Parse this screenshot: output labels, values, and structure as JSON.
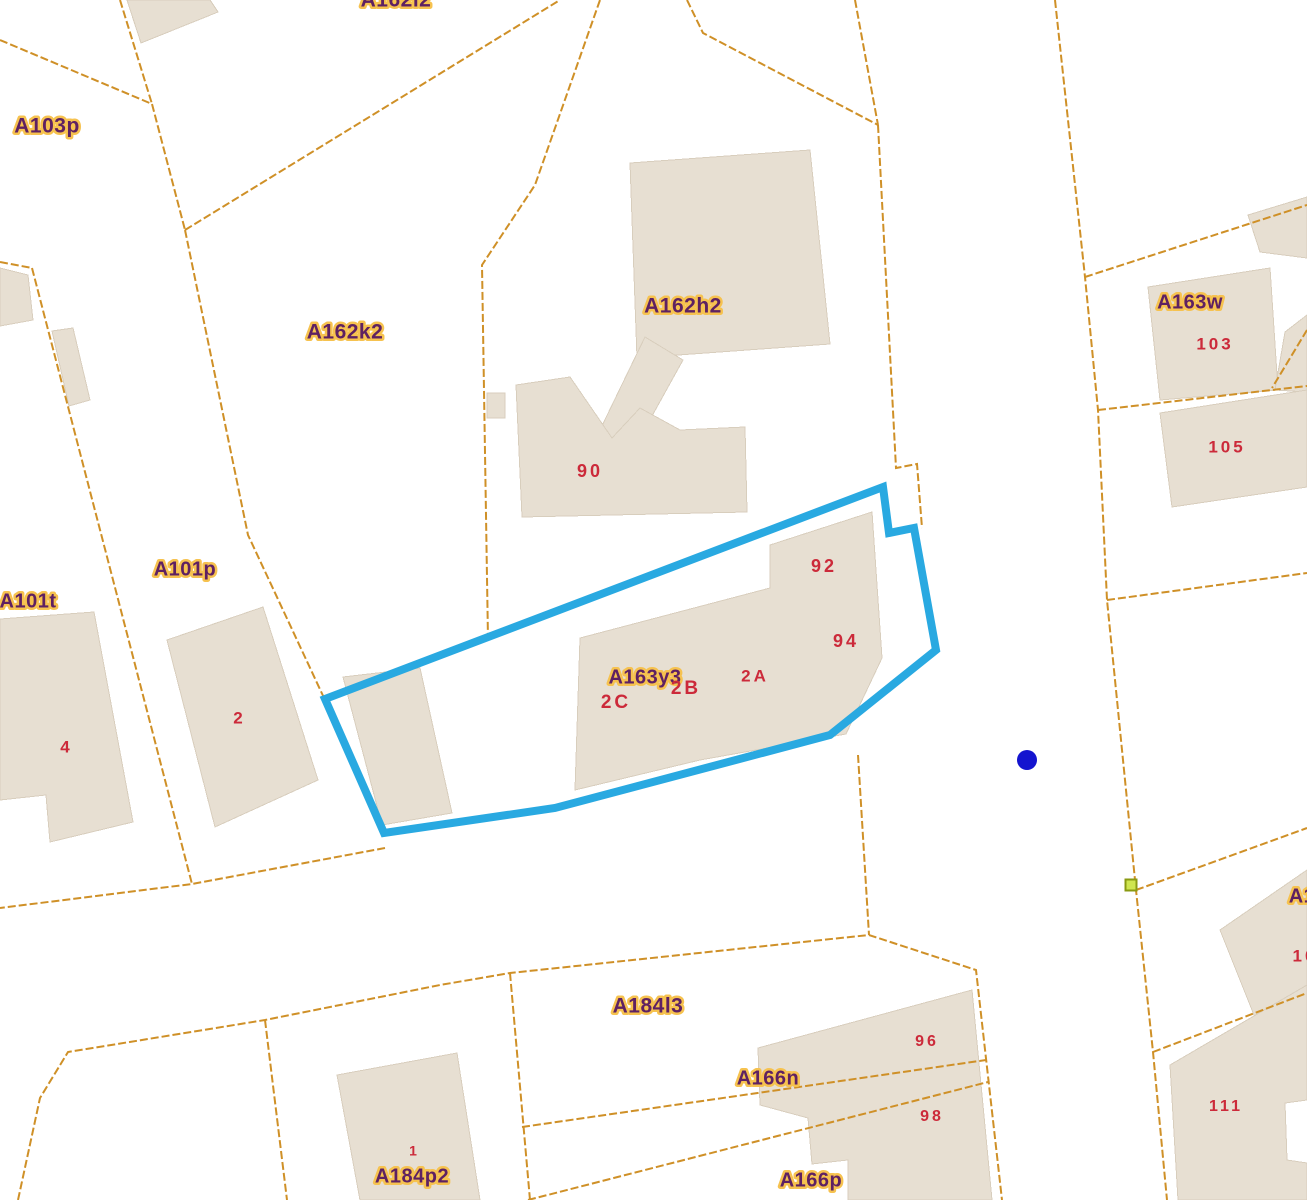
{
  "map": {
    "width": 1307,
    "height": 1200,
    "background": "#ffffff",
    "colors": {
      "parcel_line": "#cf9027",
      "building_fill": "#e7dfd2",
      "building_stroke": "#d8cebd",
      "parcel_label_fill": "#5e2162",
      "parcel_label_halo": "#f6c24f",
      "building_number_fill": "#cc2a3a",
      "highlight_stroke": "#29a9e1",
      "marker_dot_fill": "#1414cf",
      "vertex_square_fill": "#cfe550",
      "vertex_square_stroke": "#8a9a12"
    },
    "highlight_parcel": {
      "name": "selected-parcel-A163y3",
      "points": "325,699 883,487 889,533 914,528 936,650 830,735 555,808 384,833",
      "stroke_width": 8
    },
    "buildings": [
      {
        "name": "building-topleft-corner",
        "points": "127,0 210,0 218,12 141,43"
      },
      {
        "name": "building-leftedge-small",
        "points": "0,268 28,275 33,320 0,326"
      },
      {
        "name": "building-leftedge-thin",
        "points": "52,331 73,328 90,400 69,406"
      },
      {
        "name": "building-A162h2-block",
        "points": "630,163 810,150 830,344 637,358"
      },
      {
        "name": "building-A162h2-arm",
        "points": "645,337 683,360 632,452 600,430"
      },
      {
        "name": "building-90",
        "points": "516,385 570,377 612,438 640,408 680,430 745,427 747,512 522,517"
      },
      {
        "name": "building-tiny-square",
        "points": "487,393 505,393 505,418 487,418"
      },
      {
        "name": "building-4",
        "points": "0,619 94,612 133,822 50,842 46,795 0,800"
      },
      {
        "name": "building-2",
        "points": "167,640 263,607 318,780 215,827"
      },
      {
        "name": "building-outbuilding-in-parcel",
        "points": "343,677 420,668 452,813 382,825"
      },
      {
        "name": "building-92-94-2A",
        "points": "580,638 770,588 770,545 872,512 882,658 846,734 700,760 575,790"
      },
      {
        "name": "building-topright-corner",
        "points": "1248,215 1307,197 1307,258 1260,252"
      },
      {
        "name": "building-103",
        "points": "1148,287 1270,268 1278,390 1160,400"
      },
      {
        "name": "building-right-sliver",
        "points": "1285,332 1307,315 1307,392 1275,390"
      },
      {
        "name": "building-105",
        "points": "1160,413 1307,390 1307,487 1172,507"
      },
      {
        "name": "building-right-mid",
        "points": "1220,930 1307,870 1307,1010 1262,1035"
      },
      {
        "name": "building-111",
        "points": "1170,1065 1307,985 1307,1100 1285,1103 1287,1160 1307,1163 1307,1200 1178,1200"
      },
      {
        "name": "building-96-98",
        "points": "758,1048 972,990 992,1200 848,1200 848,1160 812,1164 808,1118 760,1105"
      },
      {
        "name": "building-1",
        "points": "337,1075 457,1053 480,1200 360,1200"
      }
    ],
    "parcel_lines": [
      {
        "name": "boundary",
        "points": "0,40 152,104"
      },
      {
        "name": "boundary",
        "points": "120,0 152,104"
      },
      {
        "name": "boundary",
        "points": "152,104 185,230"
      },
      {
        "name": "boundary",
        "points": "185,230 560,0"
      },
      {
        "name": "boundary",
        "points": "185,230 248,535 325,700"
      },
      {
        "name": "boundary",
        "points": "600,0 535,185 482,265 488,640"
      },
      {
        "name": "boundary",
        "points": "687,0 703,33 878,125"
      },
      {
        "name": "boundary",
        "points": "855,0 878,125"
      },
      {
        "name": "boundary",
        "points": "878,125 896,468 917,464 922,528"
      },
      {
        "name": "boundary",
        "points": "858,755 869,935"
      },
      {
        "name": "boundary",
        "points": "0,262 32,268"
      },
      {
        "name": "boundary",
        "points": "32,268 192,884"
      },
      {
        "name": "boundary",
        "points": "385,848 192,884 0,908"
      },
      {
        "name": "boundary",
        "points": "18,1200 40,1098 68,1052 265,1020 440,985 510,973 869,935 976,970 1002,1200"
      },
      {
        "name": "boundary",
        "points": "265,1020 287,1200"
      },
      {
        "name": "boundary",
        "points": "510,973 530,1200"
      },
      {
        "name": "boundary",
        "points": "522,1127 986,1060"
      },
      {
        "name": "boundary",
        "points": "528,1200 988,1082"
      },
      {
        "name": "road-boundary",
        "points": "1055,0 1085,277 1098,410 1107,600 1136,890 1153,1052 1167,1200"
      },
      {
        "name": "boundary",
        "points": "1085,277 1307,205"
      },
      {
        "name": "boundary",
        "points": "1098,410 1307,386"
      },
      {
        "name": "boundary",
        "points": "1307,330 1272,388"
      },
      {
        "name": "boundary",
        "points": "1107,600 1307,573"
      },
      {
        "name": "boundary",
        "points": "1136,890 1307,828"
      },
      {
        "name": "boundary",
        "points": "1153,1052 1307,993"
      }
    ],
    "labels": [
      {
        "text": "A103p",
        "kind": "parcel",
        "x": 47,
        "y": 127,
        "size": 21
      },
      {
        "text": "A162l2",
        "kind": "parcel",
        "x": 396,
        "y": 1,
        "size": 21
      },
      {
        "text": "A162k2",
        "kind": "parcel",
        "x": 345,
        "y": 333,
        "size": 21
      },
      {
        "text": "A162h2",
        "kind": "parcel",
        "x": 683,
        "y": 307,
        "size": 21
      },
      {
        "text": "A163w",
        "kind": "parcel",
        "x": 1190,
        "y": 303,
        "size": 20
      },
      {
        "text": "A101t",
        "kind": "parcel",
        "x": 28,
        "y": 602,
        "size": 20
      },
      {
        "text": "A101p",
        "kind": "parcel",
        "x": 185,
        "y": 570,
        "size": 20
      },
      {
        "text": "A163y3",
        "kind": "parcel",
        "x": 645,
        "y": 678,
        "size": 20
      },
      {
        "text": "A184l3",
        "kind": "parcel",
        "x": 648,
        "y": 1007,
        "size": 21
      },
      {
        "text": "A166n",
        "kind": "parcel",
        "x": 768,
        "y": 1079,
        "size": 20
      },
      {
        "text": "A166p",
        "kind": "parcel",
        "x": 811,
        "y": 1181,
        "size": 20
      },
      {
        "text": "A184p2",
        "kind": "parcel",
        "x": 412,
        "y": 1177,
        "size": 20
      },
      {
        "text": "A1",
        "kind": "parcel",
        "x": 1302,
        "y": 897,
        "size": 20
      },
      {
        "text": "90",
        "kind": "number",
        "x": 590,
        "y": 472,
        "size": 18
      },
      {
        "text": "92",
        "kind": "number",
        "x": 824,
        "y": 567,
        "size": 18
      },
      {
        "text": "94",
        "kind": "number",
        "x": 846,
        "y": 642,
        "size": 18
      },
      {
        "text": "2A",
        "kind": "number",
        "x": 755,
        "y": 677,
        "size": 17
      },
      {
        "text": "2B",
        "kind": "number",
        "x": 686,
        "y": 689,
        "size": 19
      },
      {
        "text": "2C",
        "kind": "number",
        "x": 616,
        "y": 703,
        "size": 19
      },
      {
        "text": "2",
        "kind": "number",
        "x": 238,
        "y": 719,
        "size": 17
      },
      {
        "text": "4",
        "kind": "number",
        "x": 65,
        "y": 748,
        "size": 17
      },
      {
        "text": "103",
        "kind": "number",
        "x": 1215,
        "y": 345,
        "size": 17
      },
      {
        "text": "105",
        "kind": "number",
        "x": 1227,
        "y": 448,
        "size": 17
      },
      {
        "text": "96",
        "kind": "number",
        "x": 927,
        "y": 1042,
        "size": 16
      },
      {
        "text": "98",
        "kind": "number",
        "x": 932,
        "y": 1117,
        "size": 16
      },
      {
        "text": "111",
        "kind": "number",
        "x": 1226,
        "y": 1107,
        "size": 16
      },
      {
        "text": "1",
        "kind": "number",
        "x": 413,
        "y": 1152,
        "size": 14
      },
      {
        "text": "10",
        "kind": "number",
        "x": 1305,
        "y": 957,
        "size": 17
      }
    ],
    "markers": [
      {
        "name": "point-marker-dot",
        "type": "dot",
        "x": 1027,
        "y": 760,
        "r": 10
      },
      {
        "name": "vertex-marker-square",
        "type": "square",
        "x": 1131,
        "y": 885,
        "size": 11
      }
    ]
  }
}
